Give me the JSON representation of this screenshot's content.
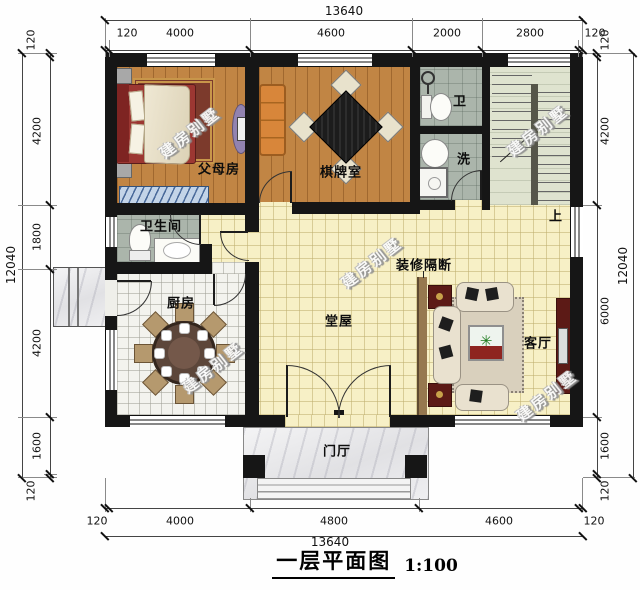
{
  "title": {
    "text": "一层平面图",
    "scale": "1:100"
  },
  "watermark_text": "建房别墅",
  "labels": {
    "parents_room": "父母房",
    "chess_room": "棋牌室",
    "toilet": "卫",
    "wash": "洗",
    "bathroom": "卫生间",
    "kitchen": "厨房",
    "main_hall": "堂屋",
    "living_room": "客厅",
    "foyer": "门厅",
    "partition": "装修隔断",
    "stairs_up": "上"
  },
  "dimensions": {
    "top": {
      "total": "13640",
      "segments": [
        "120",
        "4000",
        "4600",
        "2000",
        "2800",
        "120"
      ]
    },
    "bottom": {
      "total": "13640",
      "segments": [
        "120",
        "4000",
        "4800",
        "4600",
        "120"
      ]
    },
    "left": {
      "total": "12040",
      "segments": [
        "120",
        "4200",
        "1800",
        "4200",
        "1600",
        "120"
      ]
    },
    "right": {
      "total": "12040",
      "segments": [
        "120",
        "4200",
        "6000",
        "1600",
        "120"
      ]
    }
  },
  "colors": {
    "wall": "#161616",
    "wood_floor": "#c18544",
    "tile_floor": "#abb5ab",
    "hall_floor": "#f7f0c6",
    "kitchen_floor": "#f3f3ee",
    "stair_floor": "#dfe3cf",
    "partition": "#96784f",
    "accent_red": "#5c1a16",
    "sofa_cream": "#e9e1cf",
    "sofa_orange": "#d8863a",
    "bed_red": "#9c3732",
    "wardrobe_blue": "#c3d4e8"
  }
}
